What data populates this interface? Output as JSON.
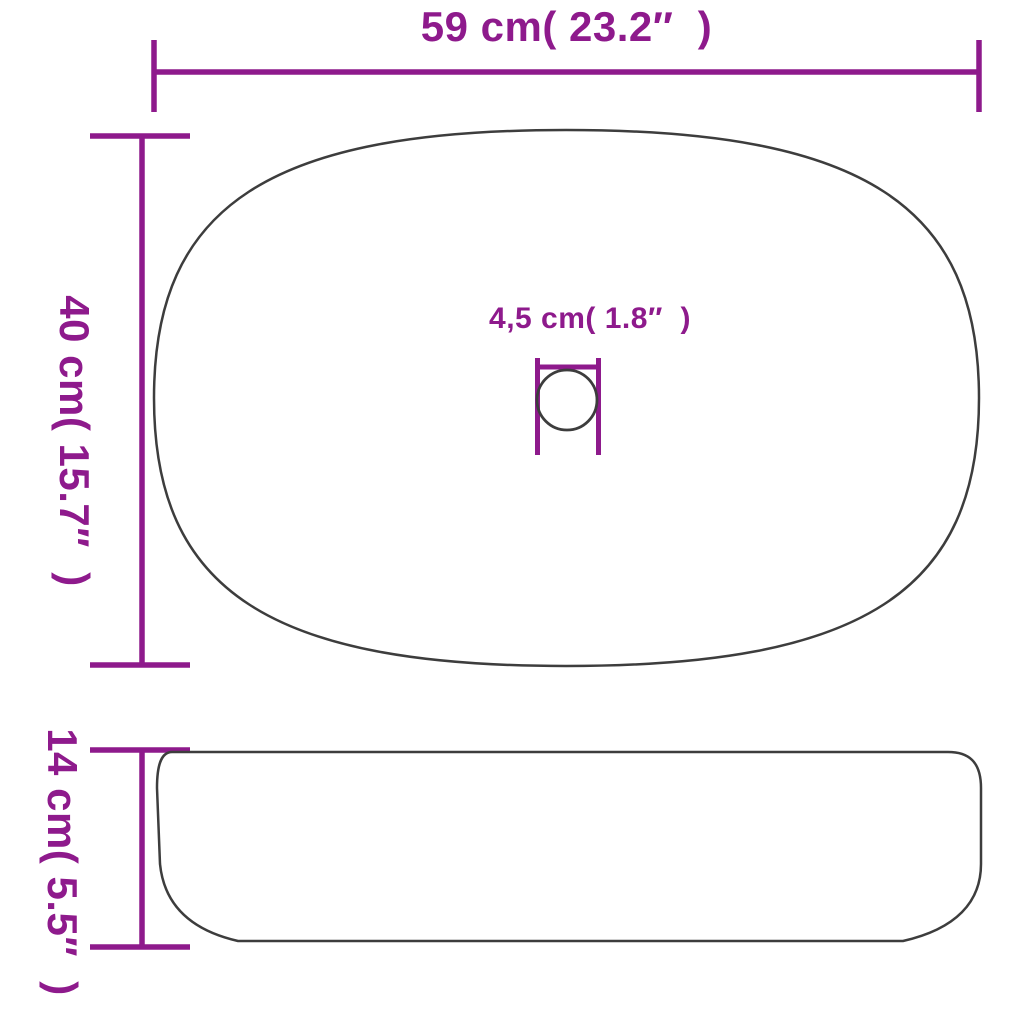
{
  "page": {
    "background": "#ffffff",
    "description": "Technical dimension diagram of an oval countertop wash basin shown in top view (with drain hole) and side view"
  },
  "colors": {
    "dimension": "#8E1A8C",
    "outline": "#3D3D3D"
  },
  "labels": {
    "width": "59 cm( 23.2″  )",
    "depth": "40 cm( 15.7″  )",
    "drain": "4,5 cm( 1.8″  )",
    "height": "14 cm( 5.5″  )"
  },
  "dimensions_data": {
    "overall_width": {
      "cm": 59,
      "inches": 23.2
    },
    "overall_depth": {
      "cm": 40,
      "inches": 15.7
    },
    "drain_diameter": {
      "cm": 4.5,
      "inches": 1.8
    },
    "overall_height": {
      "cm": 14,
      "inches": 5.5
    }
  }
}
